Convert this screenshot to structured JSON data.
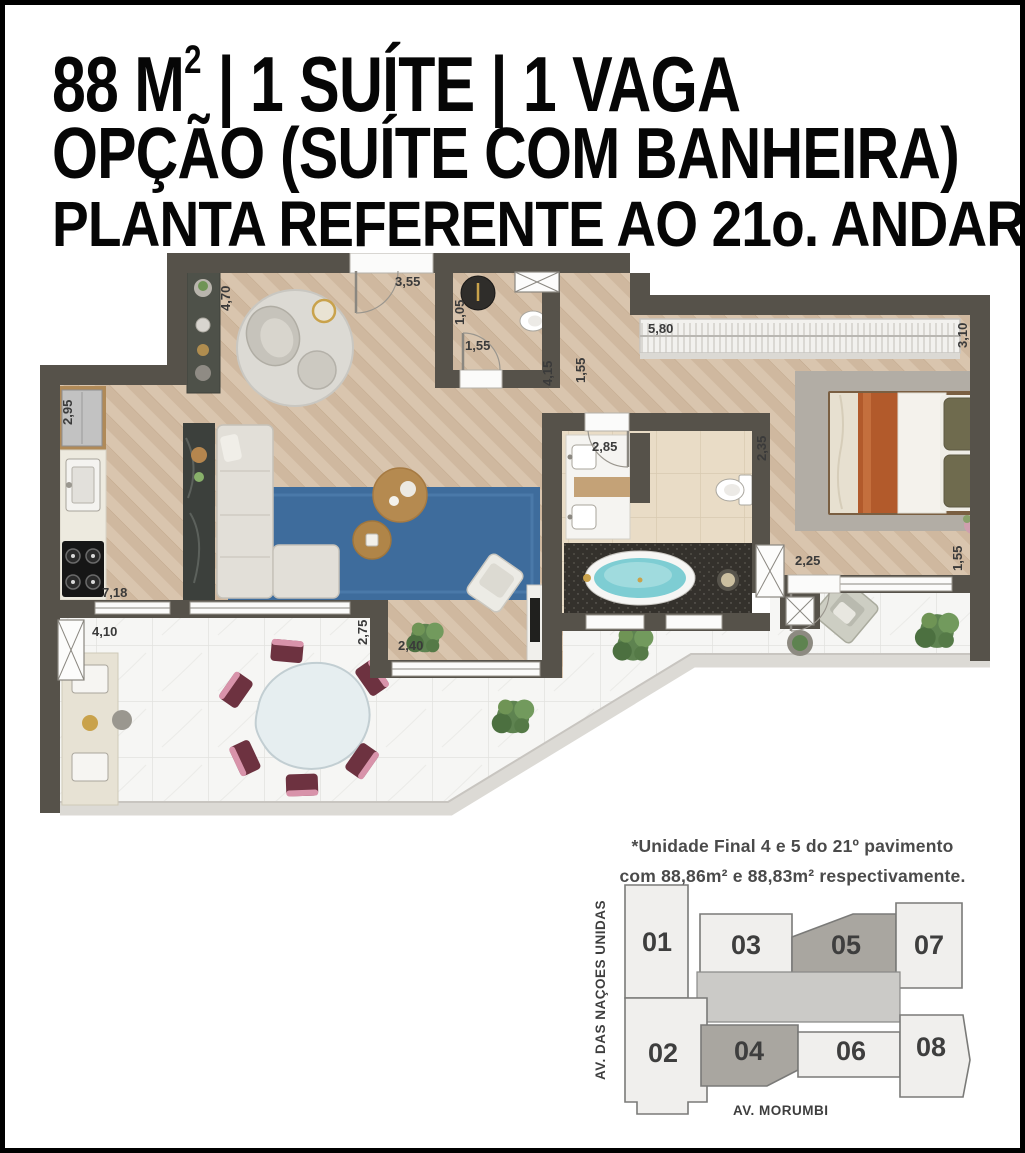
{
  "colors": {
    "wall": "#56524a",
    "wood_floor": "#d8c4ad",
    "marble_floor": "#f5f5f3",
    "bath_tile": "#e9ddc8",
    "rug_blue": "#3e6c9c",
    "bath_water": "#7ecdd3",
    "chair_burgundy": "#6d3240",
    "unit_highlight": "#a9a6a0",
    "unit_light": "#f0efed",
    "keyplan_core": "#cbcac7"
  },
  "title": {
    "line1_pre": "88 M",
    "line1_sup": "2",
    "line1_post": " | 1 SUÍTE | 1 VAGA",
    "line2": "OPÇÃO (SUÍTE COM BANHEIRA)",
    "line3": "PLANTA REFERENTE AO 21o. ANDAR"
  },
  "plan": {
    "measurements": {
      "entry_wall": "4,70",
      "entry_width": "3,55",
      "lavabo_depth": "1,05",
      "lavabo_width": "1,55",
      "closet_width": "5,80",
      "suite_depth": "3,10",
      "kitchen_depth": "2,95",
      "hall_length": "4,15",
      "hall_width": "1,55",
      "vanity_width": "2,85",
      "bath_depth": "2,35",
      "living_width": "7,18",
      "terrace_counter": "4,10",
      "nook_depth": "2,75",
      "nook_width": "2,40",
      "suite_balcony_width": "2,25",
      "suite_balcony_depth": "1,55"
    }
  },
  "keyplan": {
    "note_line1": "*Unidade Final 4 e 5 do 21º pavimento",
    "note_line2": "com 88,86m² e 88,83m² respectivamente.",
    "street_left": "AV. DAS NAÇÕES UNIDAS",
    "street_bottom": "AV. MORUMBI",
    "units": [
      {
        "label": "01",
        "highlighted": false
      },
      {
        "label": "02",
        "highlighted": false
      },
      {
        "label": "03",
        "highlighted": false
      },
      {
        "label": "04",
        "highlighted": true
      },
      {
        "label": "05",
        "highlighted": true
      },
      {
        "label": "06",
        "highlighted": false
      },
      {
        "label": "07",
        "highlighted": false
      },
      {
        "label": "08",
        "highlighted": false
      }
    ]
  }
}
